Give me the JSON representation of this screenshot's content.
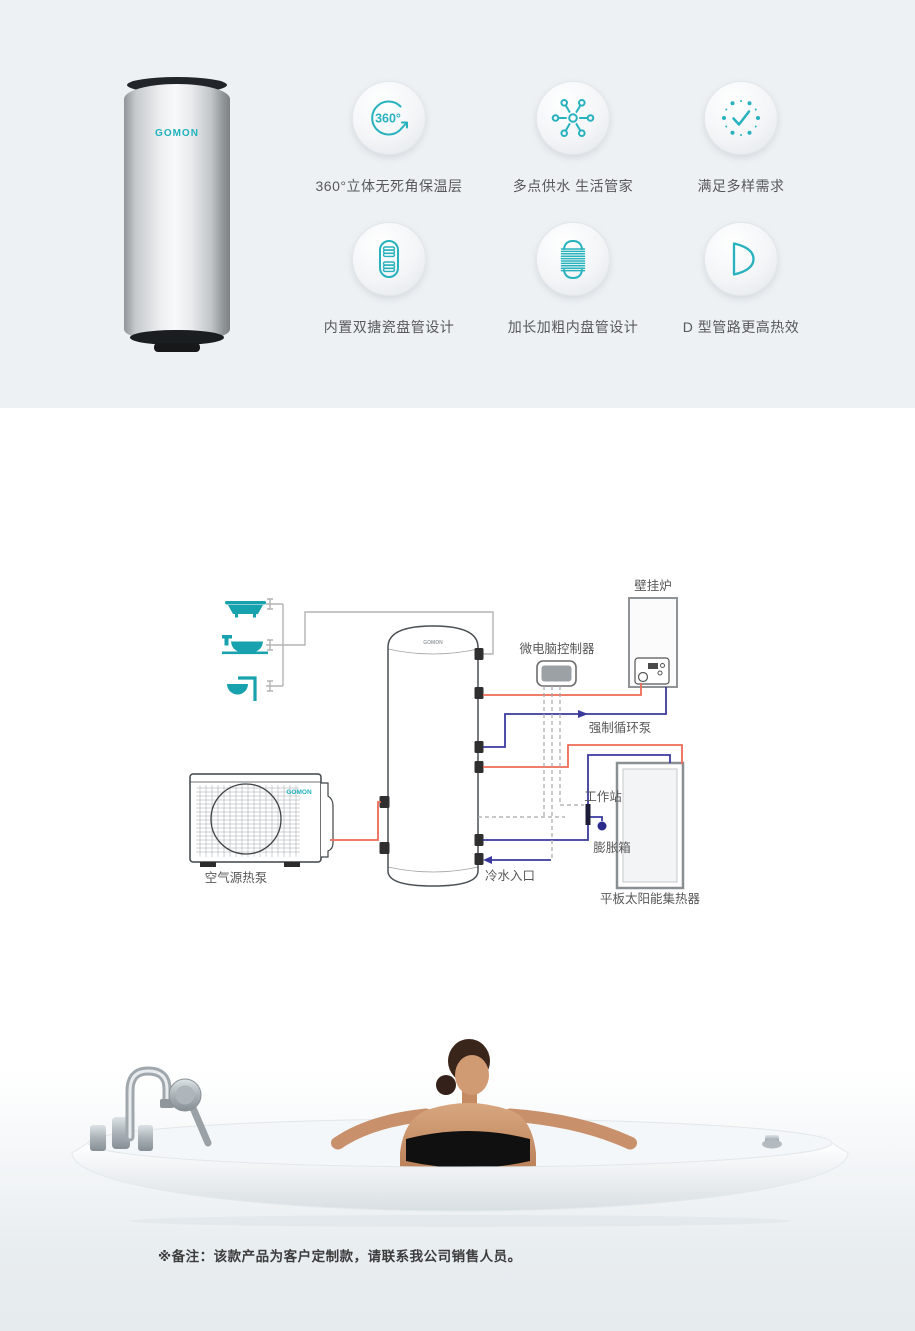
{
  "brand": {
    "name": "GOMON"
  },
  "colors": {
    "accent_teal": "#1fb2bf",
    "hot_line": "#ee6a55",
    "cold_line": "#3a3a9e",
    "section_bg": "#edf1f4",
    "fixture_teal": "#17a2ae"
  },
  "features": {
    "items": [
      {
        "icon": "rotate-360-icon",
        "badge": "360°",
        "label": "360°立体无死角保温层"
      },
      {
        "icon": "multi-point-supply-icon",
        "label": "多点供水 生活管家"
      },
      {
        "icon": "clock-check-icon",
        "label": "满足多样需求"
      },
      {
        "icon": "double-enamel-coil-icon",
        "label": "内置双搪瓷盘管设计"
      },
      {
        "icon": "long-thick-coil-icon",
        "label": "加长加粗内盘管设计"
      },
      {
        "icon": "d-type-pipe-icon",
        "label": "D 型管路更高热效"
      }
    ]
  },
  "diagram": {
    "labels": {
      "wall_boiler": "壁挂炉",
      "controller": "微电脑控制器",
      "circulation_pump": "强制循环泵",
      "workstation": "工作站",
      "expansion_tank": "膨胀箱",
      "solar_collector": "平板太阳能集热器",
      "heat_pump": "空气源热泵",
      "cold_water_inlet": "冷水入口"
    }
  },
  "footer": {
    "note": "※备注：该款产品为客户定制款，请联系我公司销售人员。"
  }
}
